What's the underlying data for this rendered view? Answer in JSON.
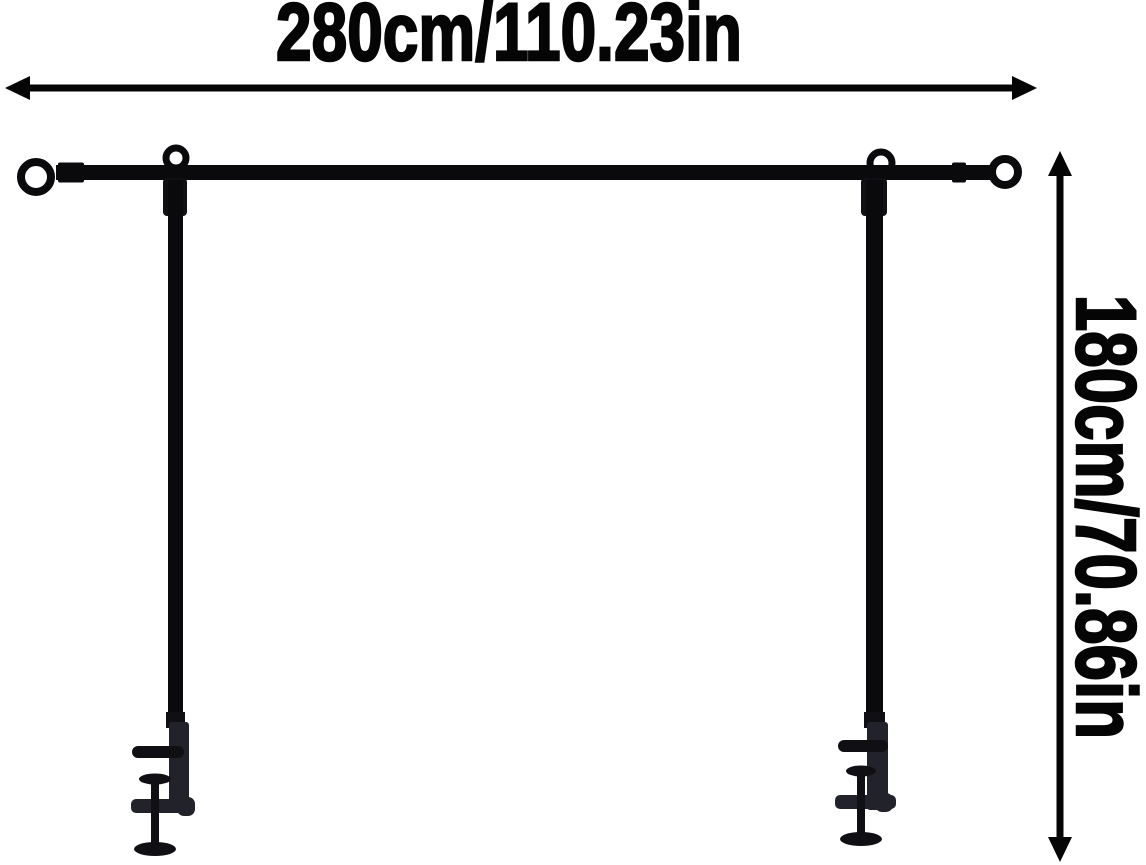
{
  "labels": {
    "width": "280cm/110.23in",
    "height": "180cm/70.86in"
  },
  "colors": {
    "background": "#ffffff",
    "ink": "#050505",
    "frame": "#0a0a0c",
    "clamp": "#22222a",
    "hardware": "#101014"
  }
}
